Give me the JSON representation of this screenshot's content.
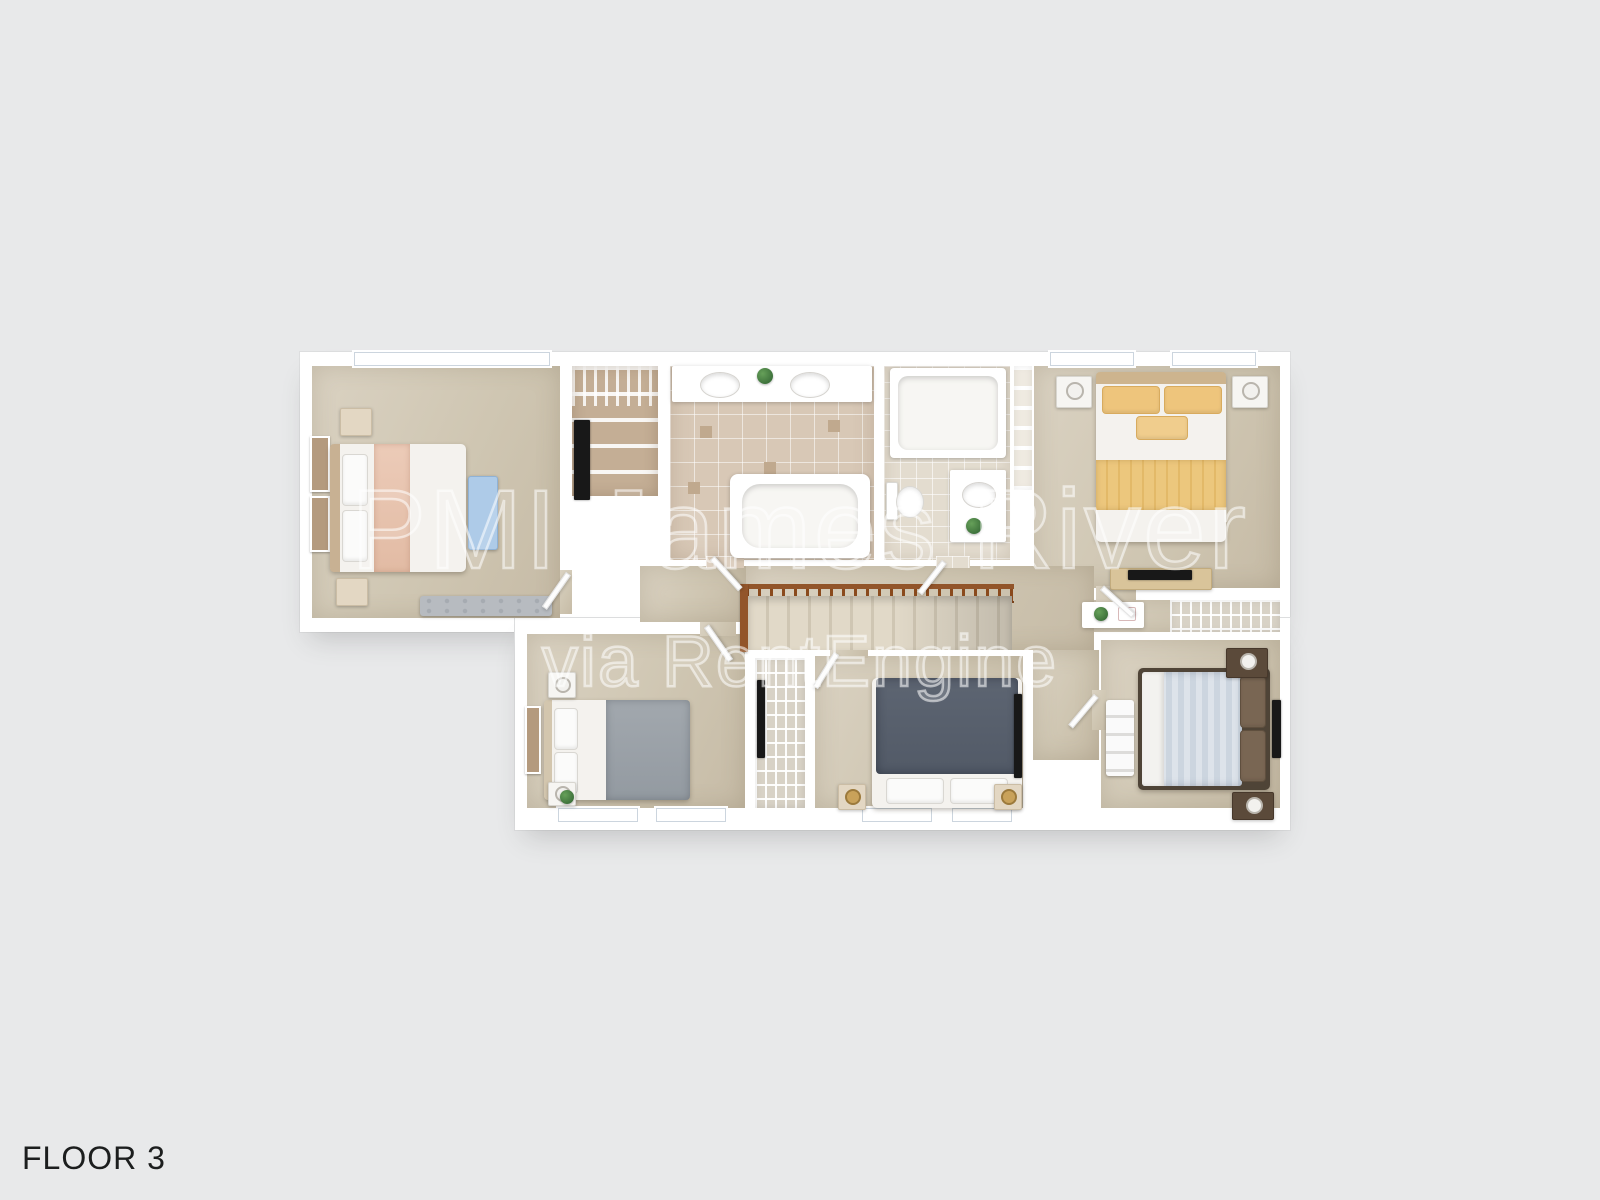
{
  "floor_label": "FLOOR 3",
  "watermark": {
    "line1": "PMI James River",
    "line2": "via RentEngine"
  },
  "colors": {
    "background": "#e8e9ea",
    "wall": "#ffffff",
    "carpet": "#cfc6b2",
    "tile_master_bath": "#d8c8b6",
    "tile_hall_bath": "#e3dccf",
    "accent_peach_blanket": "#e7c3ae",
    "accent_blue_bench": "#aecbe8",
    "accent_yellow_bedding": "#ecc77d",
    "accent_gray_bedding": "#9aa1a8",
    "accent_dark_bedding": "#59616e",
    "accent_striped_quilt": "#ccd5df",
    "stair_rail_wood": "#92552a",
    "watermark_stroke": "rgba(255,255,255,0.55)",
    "label_text": "#1c1e1e"
  }
}
